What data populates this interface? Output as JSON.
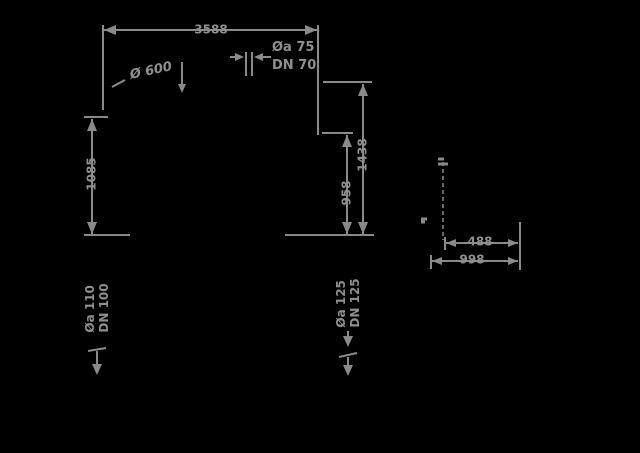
{
  "drawing": {
    "background_color": "#000000",
    "line_color": "#8a8a8a"
  },
  "main_view": {
    "width_dim": "3588",
    "left_height_dim": "1085",
    "inner_right_height_dim": "958",
    "outer_right_height_dim": "1438",
    "vent_label_line1": "Øa 75",
    "vent_label_line2": "DN 70",
    "manhole_note": "Ø 600",
    "inlet_label_line1": "Øa 110",
    "inlet_label_line2": "DN 100",
    "outlet_label_line1": "Øa 125",
    "outlet_label_line2": "DN 125"
  },
  "detail_view": {
    "width_dim": "488",
    "outer_width_dim": "998"
  }
}
